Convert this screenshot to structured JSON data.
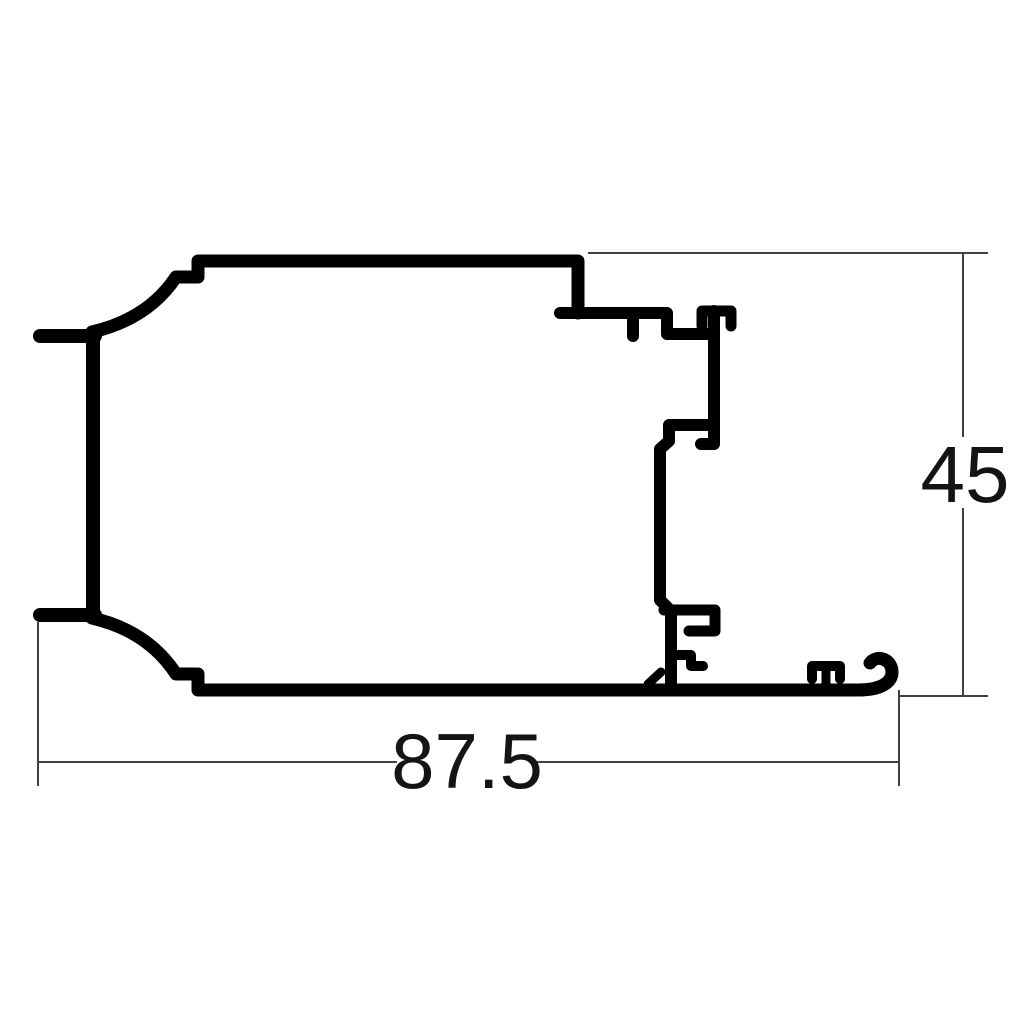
{
  "page": {
    "background": "#ffffff"
  },
  "drawing": {
    "kind": "technical-cross-section-profile",
    "description": "Aluminium extrusion profile cross-section with linear dimensions",
    "dimensions": {
      "width_label": "87.5",
      "height_label": "45"
    },
    "colors": {
      "outline": "#000000",
      "dimension_lines": "#404040",
      "text": "#141414"
    }
  }
}
